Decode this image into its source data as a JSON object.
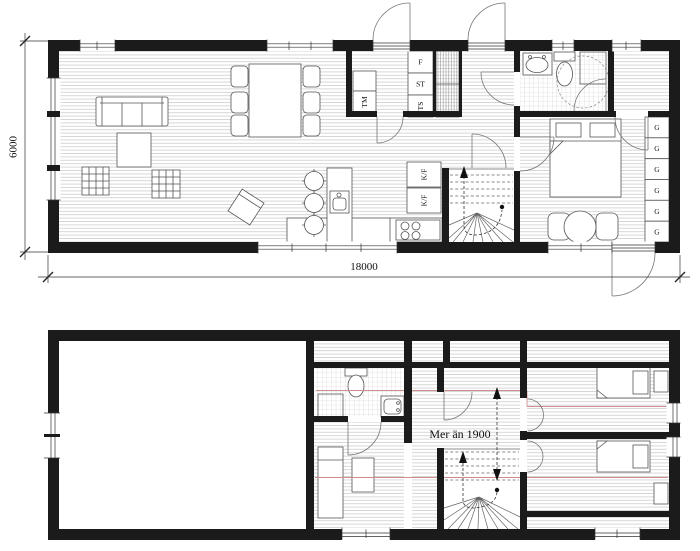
{
  "colors": {
    "wall": "#1b1b1b",
    "floor_line": "#bdbdbd",
    "tile_line": "#c9c9c9",
    "height_line": "#cf8d8d"
  },
  "ground_floor": {
    "width_dimension": "18000",
    "height_dimension": "6000",
    "appliance_labels": {
      "washing_machine": "TM",
      "freezer": "F",
      "cleaning_cabinet": "ST",
      "drying_cabinet": "TS",
      "fridge_freezer_upper": "K/F",
      "fridge_freezer_lower": "K/F"
    },
    "wardrobe_labels": [
      "G",
      "G",
      "G",
      "G",
      "G",
      "G"
    ]
  },
  "upper_floor": {
    "ceiling_height_note": "Mer än 1900"
  }
}
